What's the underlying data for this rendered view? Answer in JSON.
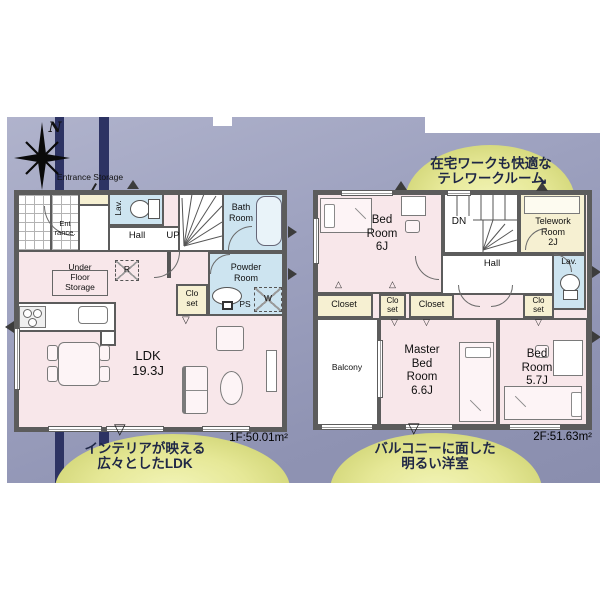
{
  "compass": {
    "label": "N"
  },
  "colors": {
    "room_pink": "#f8e7ea",
    "room_blue": "#cde4f0",
    "closet_cream": "#f6f0d2",
    "callout_yellow": "#e6e98e",
    "background_lavender": "#9da1bf",
    "stripe_navy": "#2d3363",
    "wall_gray": "#5c5c5c"
  },
  "markers": {
    "down": "▽",
    "up": "△",
    "arrow": "↘"
  },
  "callouts": {
    "telework": {
      "line1": "在宅ワークも快適な",
      "line2": "テレワークルーム"
    },
    "ldk": {
      "line1": "インテリアが映える",
      "line2": "広々としたLDK"
    },
    "bedroom": {
      "line1": "バルコニーに面した",
      "line2": "明るい洋室"
    }
  },
  "floor1": {
    "area_label": "1F:50.01m²",
    "entrance_storage_label": "Entrance Storage",
    "rooms": {
      "entrance": "Ent\nrance.",
      "lav": "Lav.",
      "hall": "Hall",
      "up": "UP",
      "bath": "Bath\nRoom",
      "powder": "Powder\nRoom",
      "ps": "PS",
      "washer": "W",
      "fridge": "R",
      "closet": "Clo\nset",
      "under_floor_storage": "Under\nFloor\nStorage",
      "ldk": "LDK\n19.3J"
    }
  },
  "floor2": {
    "area_label": "2F:51.63m²",
    "rooms": {
      "bedroom6": "Bed\nRoom\n6J",
      "dn": "DN",
      "telework": "Telework\nRoom\n2J",
      "hall": "Hall",
      "lav": "Lav.",
      "closet_left": "Closet",
      "closet_small_left": "Clo\nset",
      "closet_mid": "Closet",
      "closet_small_right": "Clo\nset",
      "balcony": "Balcony",
      "master": "Master\nBed\nRoom\n6.6J",
      "bedroom57": "Bed\nRoom\n5.7J"
    }
  }
}
